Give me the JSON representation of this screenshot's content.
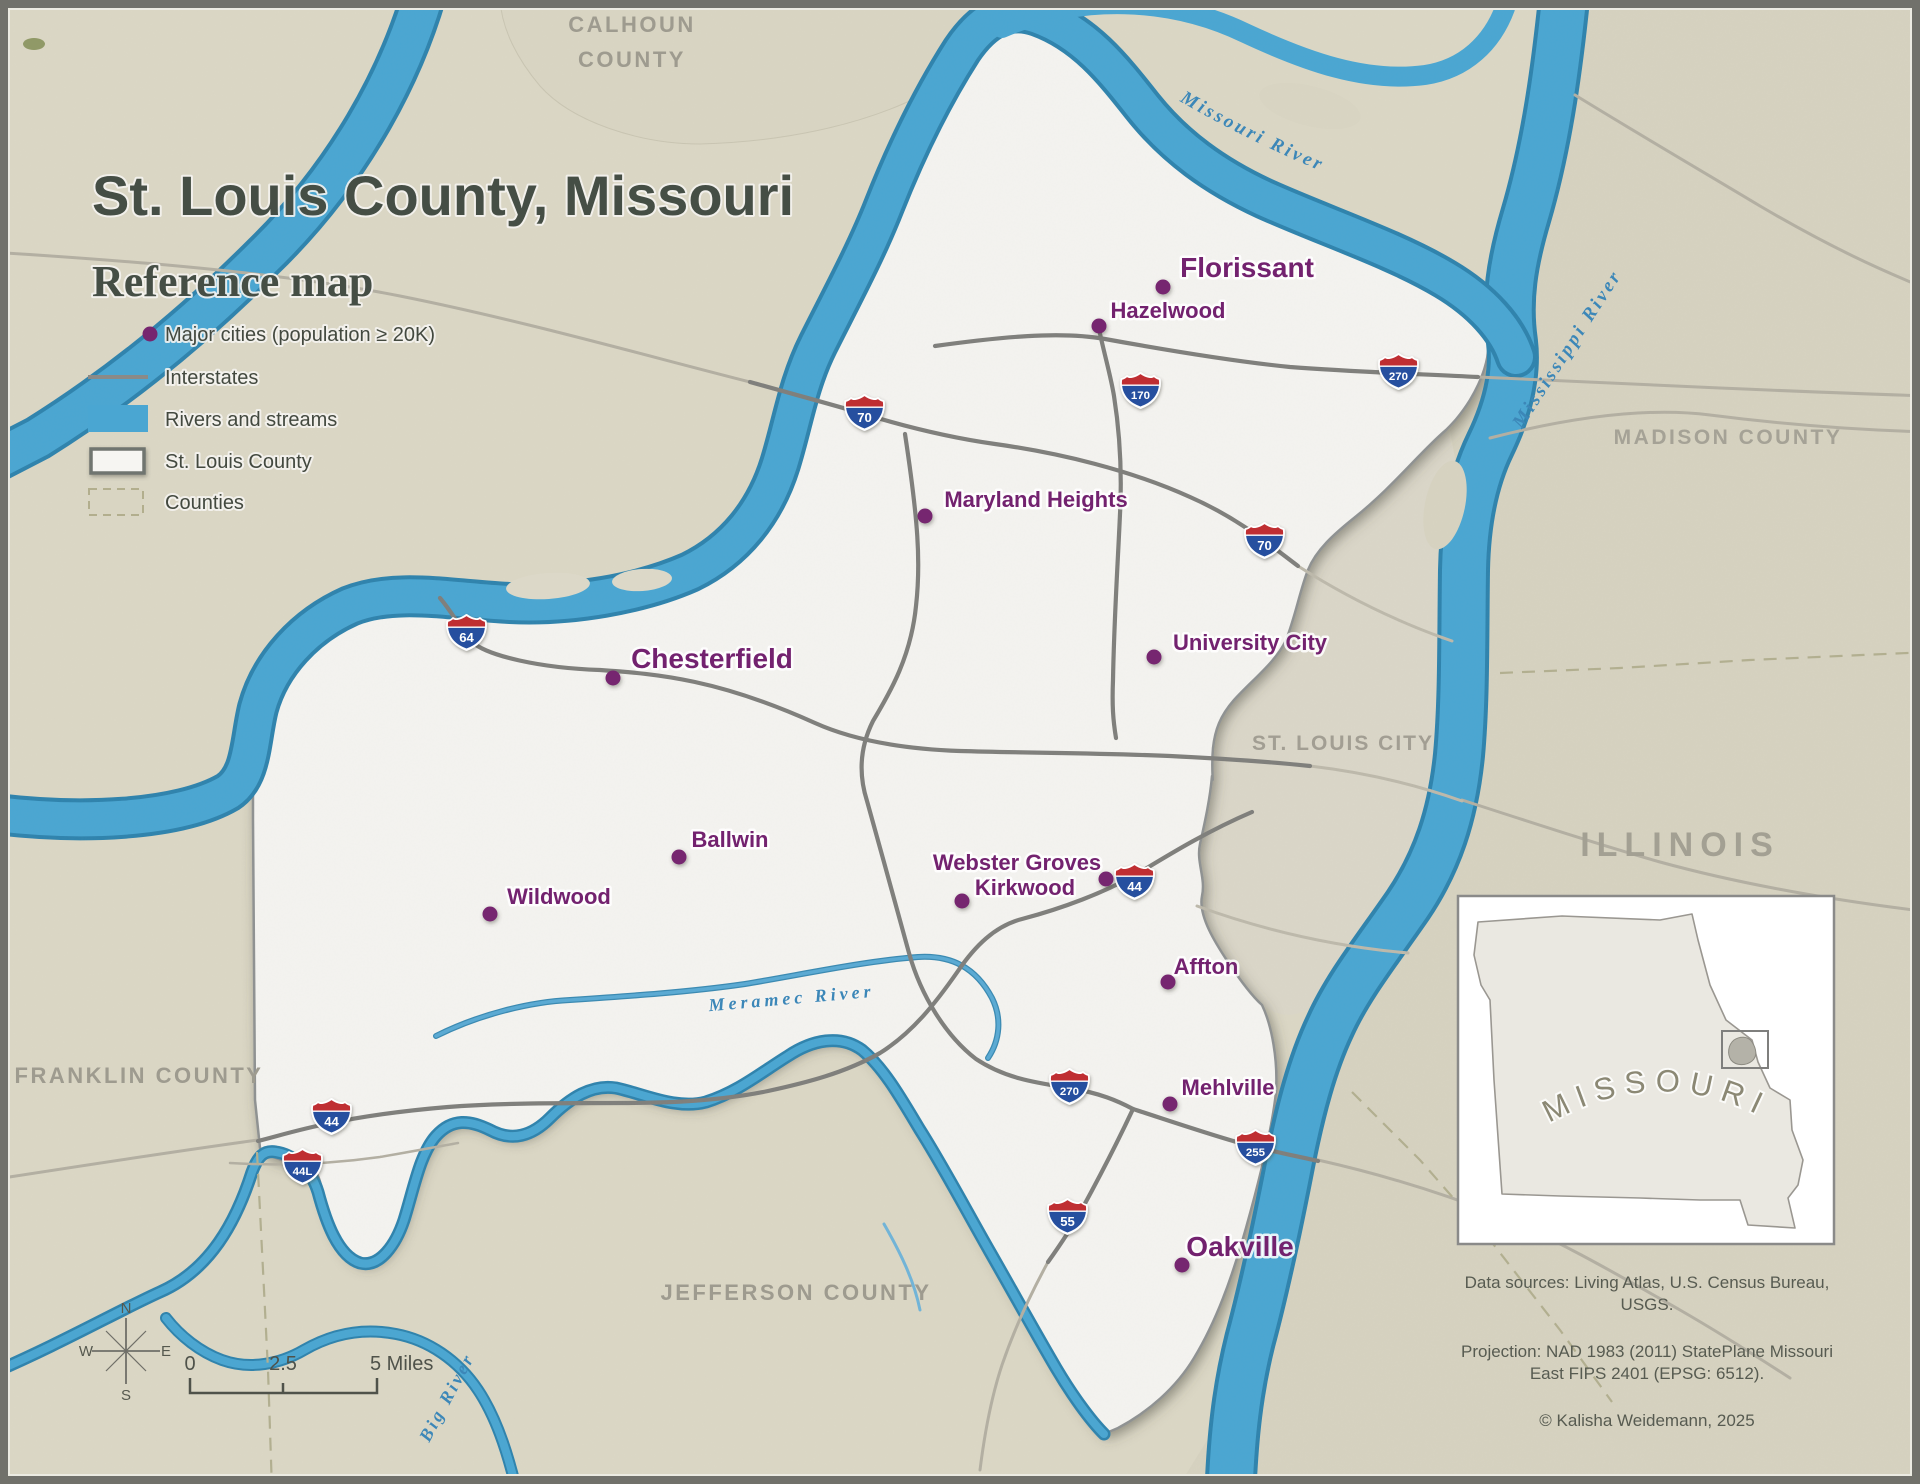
{
  "header": {
    "title": "St. Louis County, Missouri",
    "subtitle": "Reference map"
  },
  "legend": {
    "major_cities": "Major cities (population ≥ 20K)",
    "interstates": "Interstates",
    "rivers_streams": "Rivers and streams",
    "st_louis_county": "St. Louis County",
    "counties": "Counties"
  },
  "cities": [
    {
      "name": "Florissant",
      "size": "large"
    },
    {
      "name": "Hazelwood",
      "size": "regular"
    },
    {
      "name": "Maryland Heights",
      "size": "regular"
    },
    {
      "name": "University City",
      "size": "regular"
    },
    {
      "name": "Chesterfield",
      "size": "large"
    },
    {
      "name": "Ballwin",
      "size": "regular"
    },
    {
      "name": "Wildwood",
      "size": "regular"
    },
    {
      "name": "Webster Groves",
      "size": "regular"
    },
    {
      "name": "Kirkwood",
      "size": "regular"
    },
    {
      "name": "Affton",
      "size": "regular"
    },
    {
      "name": "Mehlville",
      "size": "regular"
    },
    {
      "name": "Oakville",
      "size": "large"
    }
  ],
  "shields": [
    {
      "num": "70"
    },
    {
      "num": "170"
    },
    {
      "num": "270"
    },
    {
      "num": "70"
    },
    {
      "num": "64"
    },
    {
      "num": "44"
    },
    {
      "num": "270"
    },
    {
      "num": "255"
    },
    {
      "num": "55"
    },
    {
      "num": "44"
    },
    {
      "num": "44L"
    }
  ],
  "areas": {
    "calhoun_line1": "CALHOUN",
    "calhoun_line2": "COUNTY",
    "madison": "MADISON COUNTY",
    "st_louis_city": "ST. LOUIS CITY",
    "illinois": "ILLINOIS",
    "franklin": "FRANKLIN COUNTY",
    "jefferson": "JEFFERSON COUNTY"
  },
  "water_labels": {
    "missouri": "Missouri River",
    "mississippi": "Mississippi River",
    "meramec": "Meramec River",
    "big": "Big River"
  },
  "inset": {
    "state_label": "MISSOURI"
  },
  "compass": {
    "n": "N",
    "e": "E",
    "s": "S",
    "w": "W"
  },
  "scale_bar": {
    "start": "0",
    "middle": "2.5",
    "end": "5 Miles"
  },
  "credits": {
    "sources_line1": "Data sources: Living Atlas, U.S. Census Bureau,",
    "sources_line2": "USGS.",
    "projection_line1": "Projection: NAD 1983 (2011) StatePlane Missouri",
    "projection_line2": "East FIPS 2401 (EPSG: 6512).",
    "copyright": "© Kalisha Weidemann, 2025"
  },
  "colors": {
    "city_marker": "#76256f",
    "water": "#4aa6d2",
    "water_dark": "#2f83ad",
    "county_fill": "#f4f3f0",
    "interstate": "#7f7f7c",
    "shield_red": "#bf2e33",
    "shield_blue": "#26509f",
    "background": "#dbd7c5"
  }
}
